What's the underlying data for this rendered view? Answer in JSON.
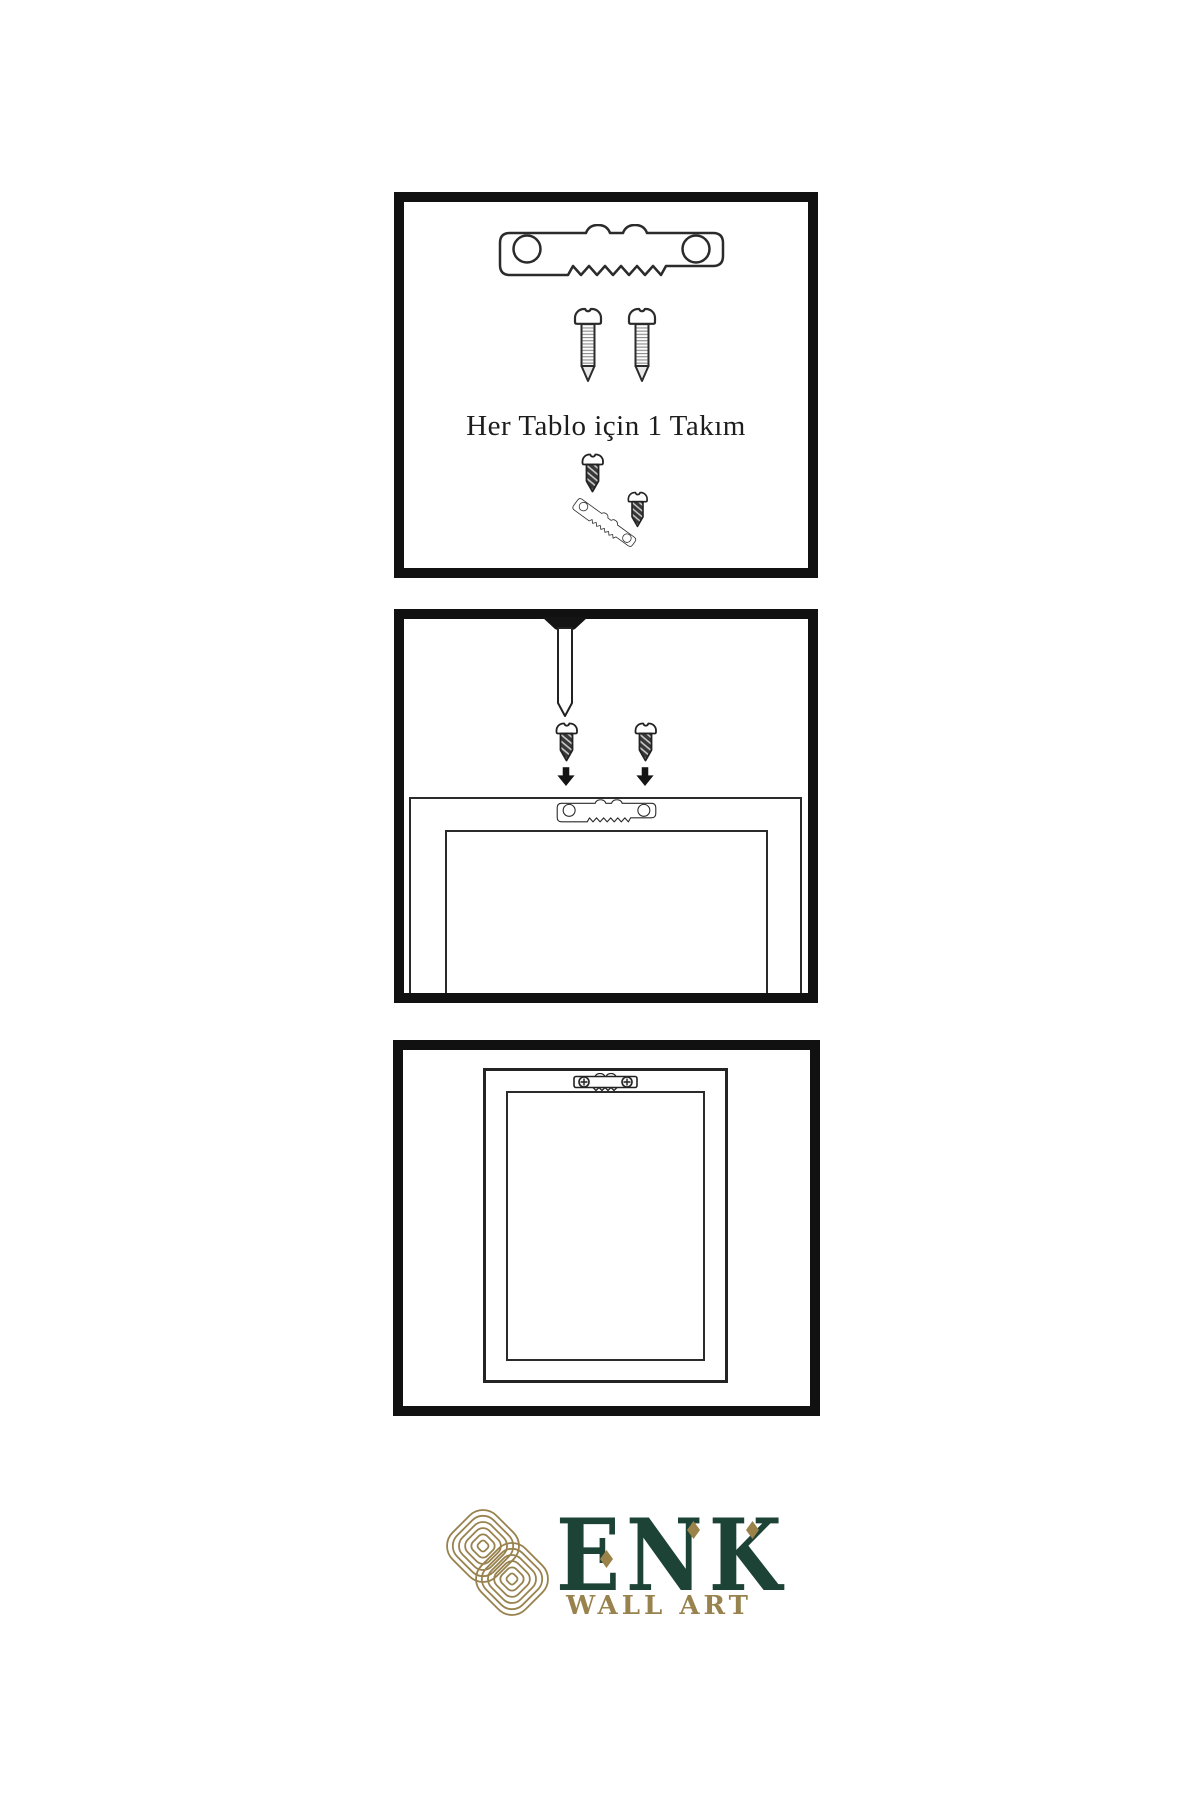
{
  "page": {
    "background": "#ffffff",
    "line_color": "#2b2b2b"
  },
  "panels": [
    {
      "name": "hardware-kit",
      "caption": "Her Tablo için 1 Takım",
      "items": [
        "sawtooth-hanger",
        "mounting-screw",
        "mounting-screw",
        "screw-driven-into-tilted-hanger",
        "mounting-screw"
      ]
    },
    {
      "name": "attach-hanger-step",
      "items": [
        "wall-nail",
        "screw",
        "screw",
        "down-arrow",
        "down-arrow",
        "frame-back-outline",
        "sawtooth-hanger-on-frame"
      ]
    },
    {
      "name": "hang-frame-step",
      "items": [
        "frame-front-outline",
        "installed-sawtooth-hanger-with-phillips-screws"
      ]
    }
  ],
  "logo": {
    "brand": "ENK",
    "subtitle": "WALL ART",
    "icon": "interlaced-knot",
    "colors": {
      "gold": "#98824e",
      "green": "#1c4336"
    }
  }
}
